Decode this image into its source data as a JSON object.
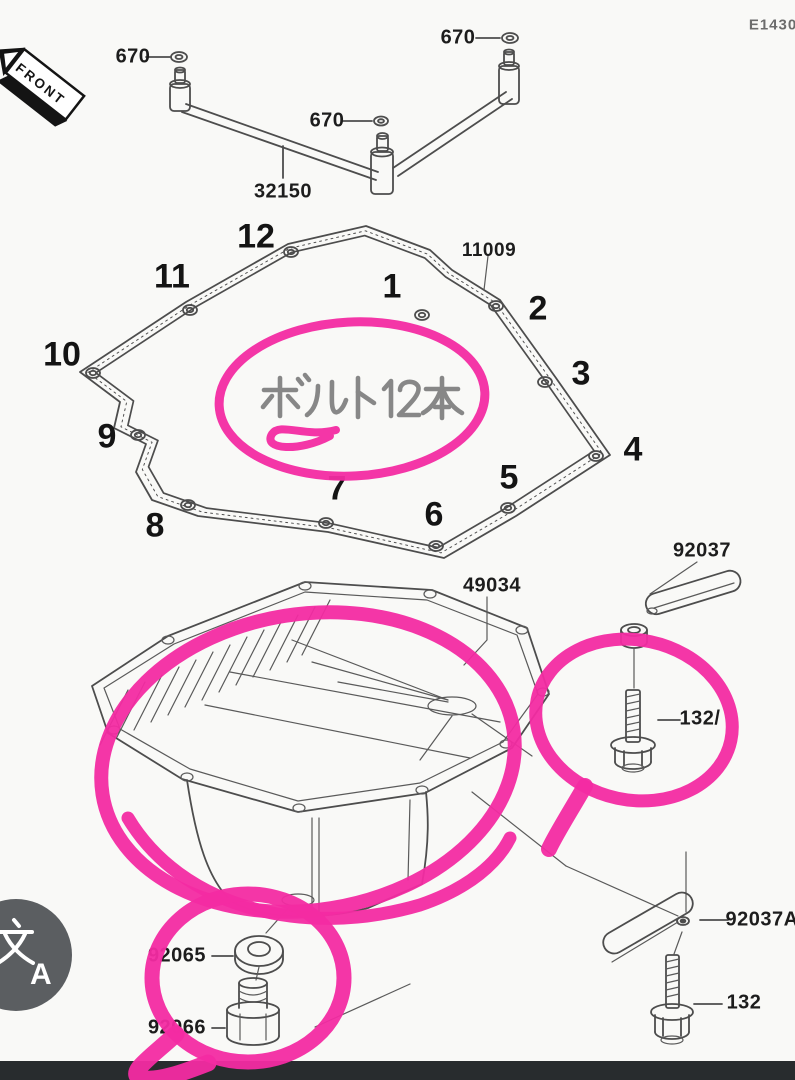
{
  "page": {
    "code": "E1430"
  },
  "front_tag": {
    "label": "FRONT"
  },
  "note": {
    "text": "ボルト12本"
  },
  "labels": {
    "oring_1": "670",
    "oring_2": "670",
    "oring_3": "670",
    "pipe": "32150",
    "gasket": "11009",
    "oil_pan": "49034",
    "clamp_upper": "92037",
    "bolt_upper": "132/",
    "clamp_lower": "92037A",
    "bolt_lower": "132",
    "washer": "92065",
    "drain_plug": "92066"
  },
  "gasket_positions": [
    "1",
    "2",
    "3",
    "4",
    "5",
    "6",
    "7",
    "8",
    "9",
    "10",
    "11",
    "12"
  ],
  "translate_button": {
    "icon": "translate-icon",
    "latin_letter": "A",
    "cjk_char": "文"
  },
  "colors": {
    "marker_pink": "#F32BA2",
    "line_gray": "#4d4d4d",
    "note_gray": "#8a8a8a",
    "bottom_bar": "#282c2e",
    "translate_bg": "#5b5e61"
  }
}
